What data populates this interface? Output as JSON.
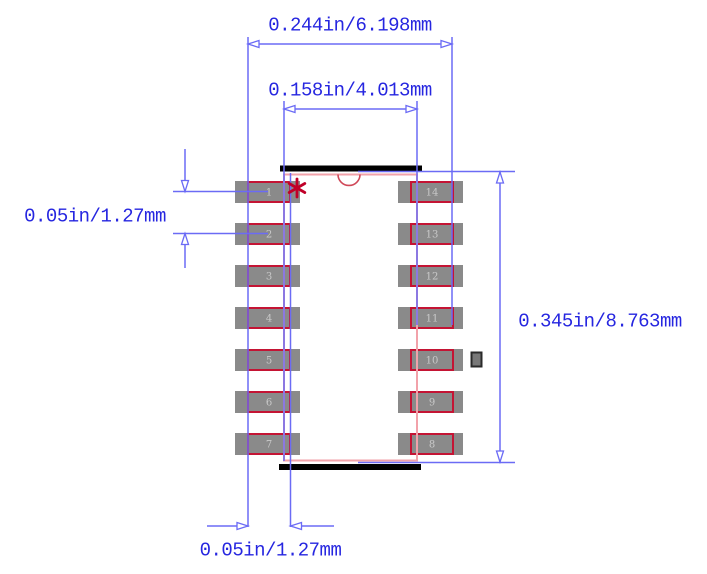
{
  "drawing": {
    "title": "14-pin SOIC package footprint dimension drawing",
    "labels": {
      "overall_width": "0.244in/6.198mm",
      "body_width": "0.158in/4.013mm",
      "pad_pitch": "0.05in/1.27mm",
      "overall_height": "0.345in/8.763mm",
      "pad_length": "0.05in/1.27mm"
    },
    "pads": {
      "left": [
        "1",
        "2",
        "3",
        "4",
        "5",
        "6",
        "7"
      ],
      "right": [
        "14",
        "13",
        "12",
        "11",
        "10",
        "9",
        "8"
      ]
    },
    "colors": {
      "dimension_line": "#6b6bf5",
      "dimension_text": "#2626e0",
      "body_outline": "#f2a2aa",
      "pad_outline": "#c41434",
      "pad_fill": "#8a8a8a",
      "pad_number": "#c9c9c9",
      "pin1_marker": "#c00028",
      "notch": "#d04858",
      "silkscreen": "#000000",
      "background": "#ffffff"
    }
  }
}
